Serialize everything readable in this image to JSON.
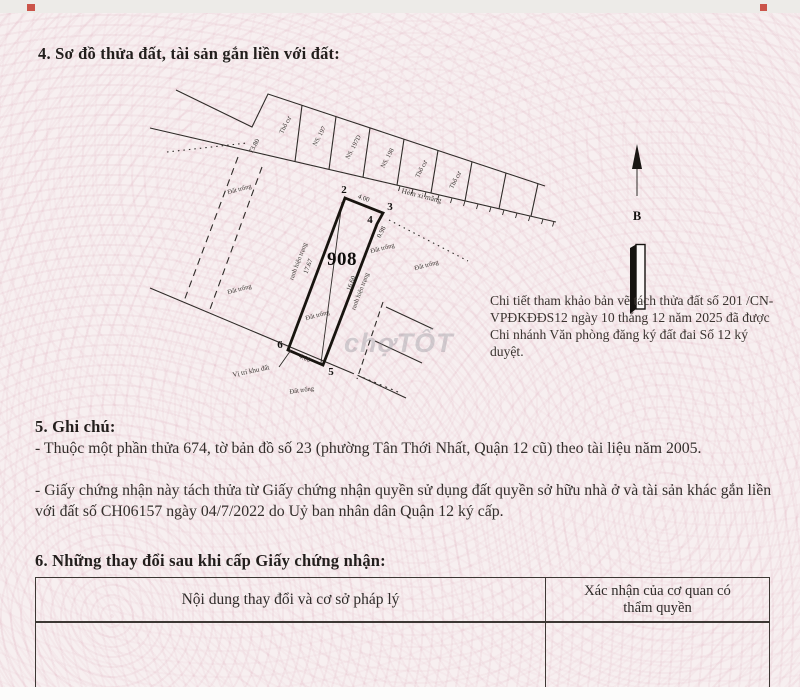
{
  "doc": {
    "section4_heading": "4. Sơ đồ thửa đất, tài sản gắn liền với đất:",
    "reference_note": "Chi tiết tham khảo bản vẽ tách thửa đất số  201 /CN-VPĐKĐĐS12 ngày 10 tháng 12 năm 2025 đã được Chi nhánh Văn phòng đăng ký đất đai Số 12 ký duyệt.",
    "section5_heading": "5. Ghi chú:",
    "section5_notes": [
      "- Thuộc một phần thửa 674, tờ bản đồ số 23 (phường Tân Thới Nhất, Quận 12 cũ) theo tài liệu năm 2005.",
      "- Giấy chứng nhận này tách thửa từ Giấy chứng nhận quyền sử dụng đất quyền sở hữu nhà ở và tài sản khác gắn liền với đất số CH06157 ngày 04/7/2022 do Uỷ ban nhân dân Quận 12 ký cấp."
    ],
    "section6_heading": "6. Những thay đổi sau khi cấp Giấy chứng nhận:",
    "table": {
      "col1_header": "Nội dung thay đổi và cơ sở pháp lý",
      "col2_header": "Xác nhận của cơ quan có thẩm quyền"
    }
  },
  "diagram": {
    "plot_number": "908",
    "corners": {
      "c2": "2",
      "c3": "3",
      "c4": "4",
      "c5": "5",
      "c6": "6"
    },
    "lengths": {
      "top": "4.00",
      "right_short": "0.98",
      "right": "16.60",
      "left": "17.67",
      "bottom": "4.00",
      "offset_left": "73.80"
    },
    "edge_left_label": "ranh hiện trạng",
    "edge_right_label": "ranh hiện trạng",
    "alley": "Hẻm xi măng",
    "location": "Vị trí khu đất",
    "empty_land": "Đất trống",
    "north": "B",
    "front_plots": [
      "Thổ cư",
      "NS. 197",
      "NS. 197D",
      "NS. 198",
      "Thổ cư",
      "Thổ cư"
    ]
  },
  "watermark": "chợTỐT"
}
